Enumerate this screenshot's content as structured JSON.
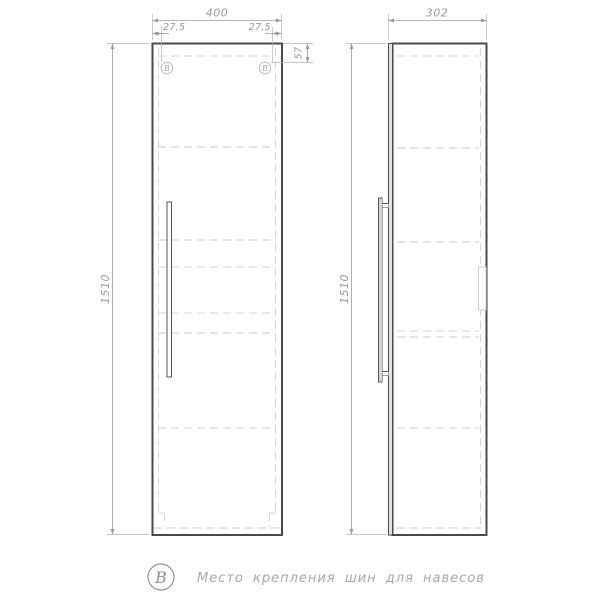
{
  "drawing": {
    "title": "wall-cabinet technical drawing",
    "front_view": {
      "width_label": "400",
      "height_label": "1510",
      "left_mount_offset_label": "27,5",
      "right_mount_offset_label": "27,5",
      "mount_drop_label": "57",
      "mount_markers": [
        "B",
        "B"
      ]
    },
    "side_view": {
      "depth_label": "302",
      "height_label": "1510"
    },
    "legend": {
      "symbol": "B",
      "text": "Место крепления шин для навесов"
    },
    "colors": {
      "outline": "#4a4a4a",
      "hidden_line": "#c9c9c9",
      "dimension": "#9a9a9a",
      "background": "#ffffff"
    }
  }
}
